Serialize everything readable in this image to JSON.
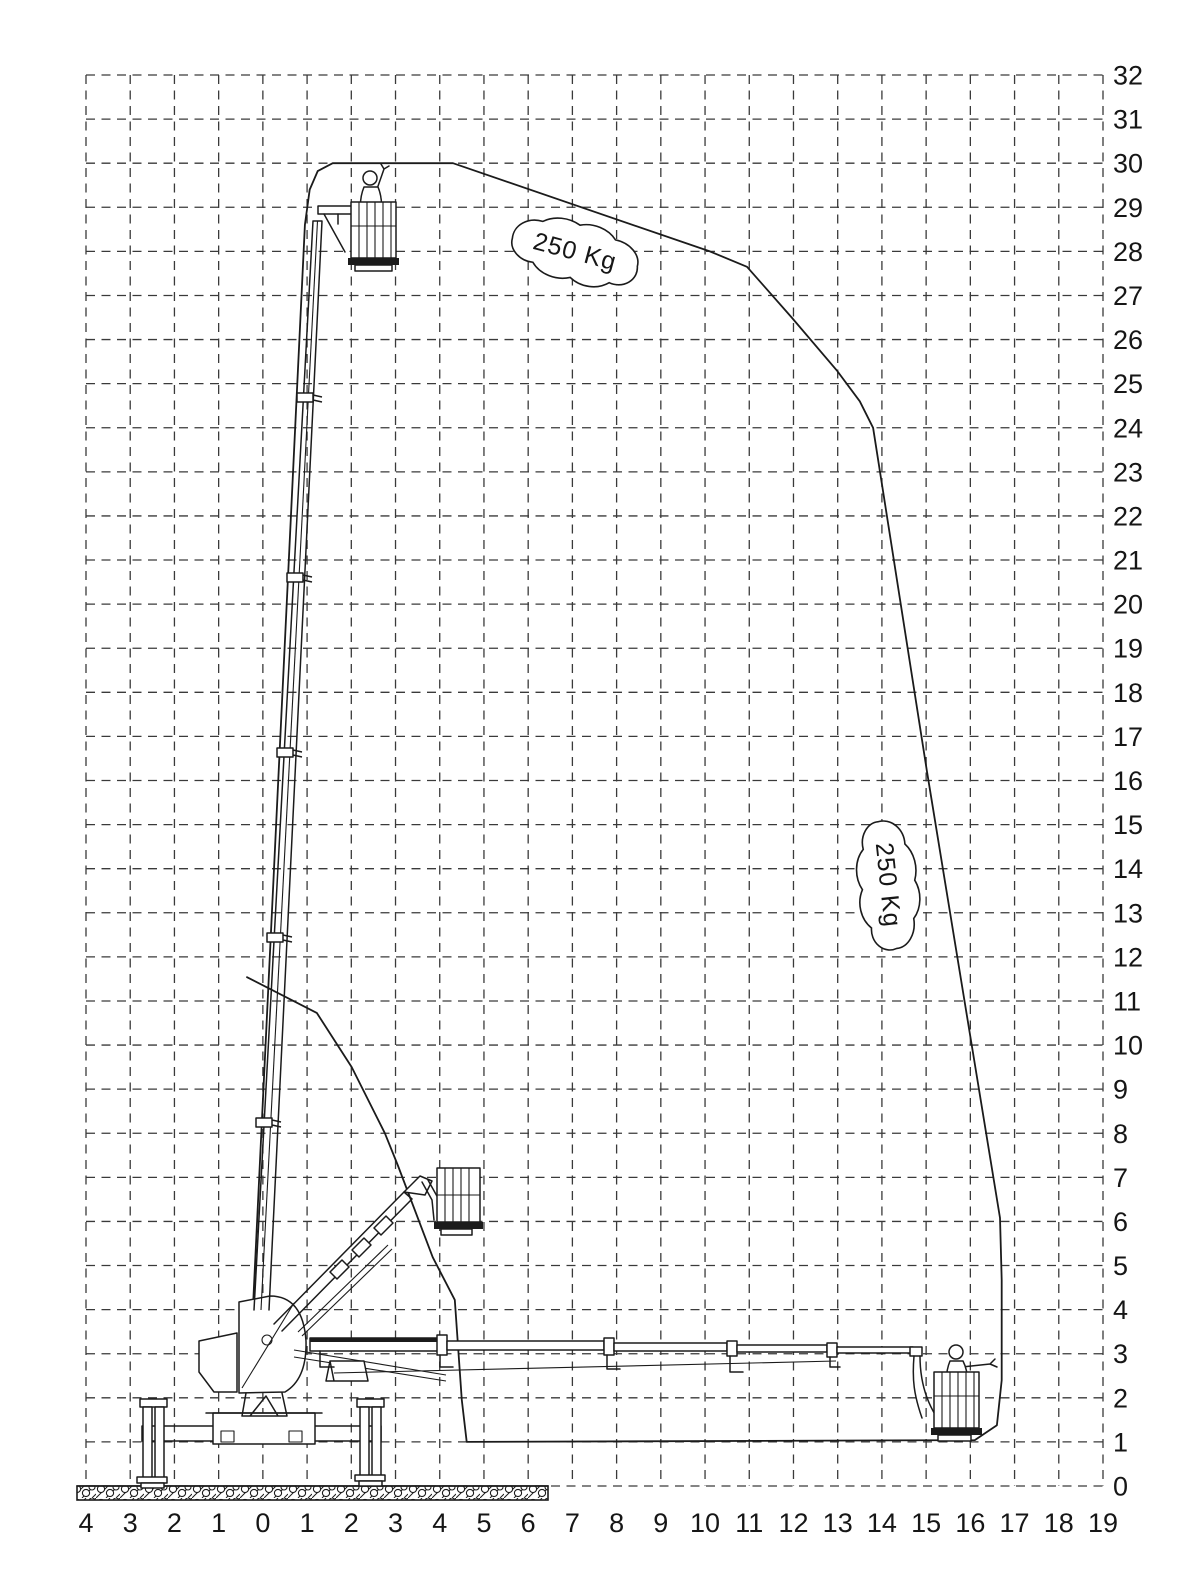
{
  "page": {
    "background": "#ffffff",
    "line_color": "#1b1b1b"
  },
  "chart_data": {
    "type": "area",
    "grid": true,
    "x_axis": {
      "min": -4,
      "max": 19,
      "tick_labels": [
        "4",
        "3",
        "2",
        "1",
        "0",
        "1",
        "2",
        "3",
        "4",
        "5",
        "6",
        "7",
        "8",
        "9",
        "10",
        "11",
        "12",
        "13",
        "14",
        "15",
        "16",
        "17",
        "18",
        "19"
      ]
    },
    "y_axis": {
      "min": 0,
      "max": 32,
      "tick_labels": [
        "0",
        "1",
        "2",
        "3",
        "4",
        "5",
        "6",
        "7",
        "8",
        "9",
        "10",
        "11",
        "12",
        "13",
        "14",
        "15",
        "16",
        "17",
        "18",
        "19",
        "20",
        "21",
        "22",
        "23",
        "24",
        "25",
        "26",
        "27",
        "28",
        "29",
        "30",
        "31",
        "32"
      ]
    },
    "envelope_m": [
      [
        -0.25,
        3.5
      ],
      [
        0.95,
        28.6
      ],
      [
        1.06,
        29.4
      ],
      [
        1.24,
        29.82
      ],
      [
        1.58,
        30.0
      ],
      [
        4.3,
        30.0
      ],
      [
        10.11,
        28.0
      ],
      [
        10.95,
        27.65
      ],
      [
        11.96,
        26.5
      ],
      [
        12.98,
        25.3
      ],
      [
        13.5,
        24.6
      ],
      [
        13.8,
        24.0
      ],
      [
        15.02,
        16.2
      ],
      [
        16.67,
        6.08
      ],
      [
        16.71,
        4.67
      ],
      [
        16.71,
        2.4
      ],
      [
        16.6,
        1.38
      ],
      [
        16.1,
        1.04
      ],
      [
        4.61,
        1.0
      ],
      [
        4.5,
        1.95
      ],
      [
        4.34,
        4.22
      ],
      [
        3.84,
        5.19
      ],
      [
        3.05,
        7.28
      ],
      [
        2.76,
        8.0
      ],
      [
        2.01,
        9.5
      ],
      [
        1.22,
        10.73
      ],
      [
        -0.36,
        11.54
      ]
    ],
    "load_labels": [
      {
        "text": "250 Kg",
        "x_m": 7.06,
        "y_m": 27.99,
        "rotation_deg": 15
      },
      {
        "text": "250 Kg",
        "x_m": 14.14,
        "y_m": 13.63,
        "rotation_deg": 84
      }
    ]
  }
}
